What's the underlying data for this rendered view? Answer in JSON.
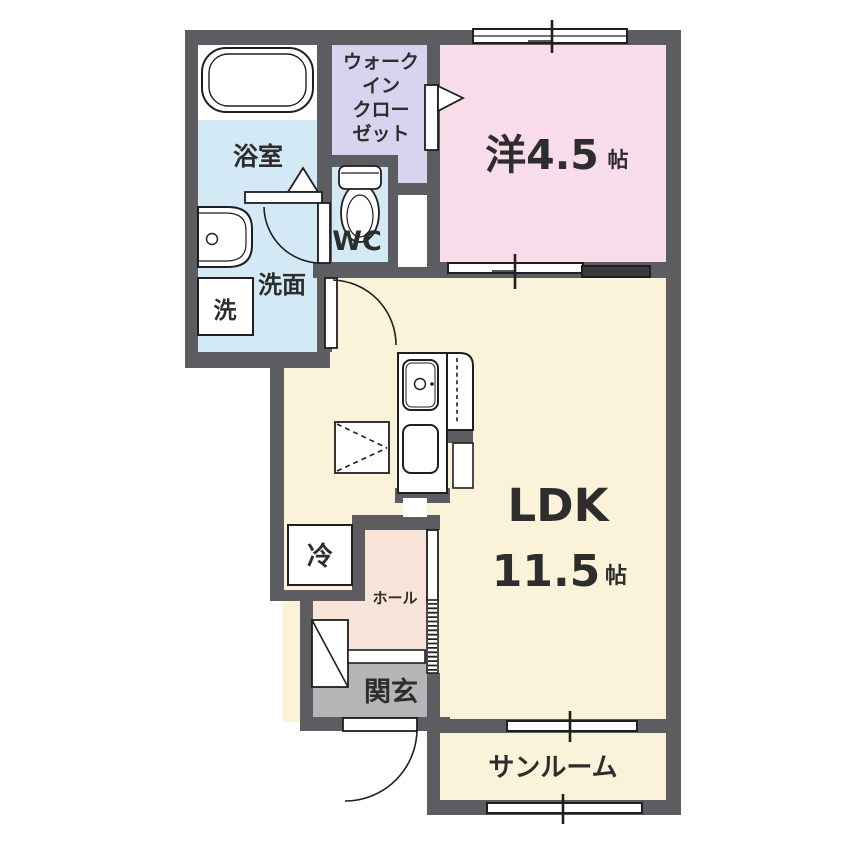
{
  "floorplan": {
    "rooms": {
      "walk_in_closet": {
        "line1": "ウォーク",
        "line2": "イン",
        "line3": "クロー",
        "line4": "ゼット"
      },
      "bathroom": {
        "label": "浴室"
      },
      "washroom": {
        "label": "洗面"
      },
      "washing_machine": {
        "label": "洗"
      },
      "toilet": {
        "label": "WC"
      },
      "western_room": {
        "size_label": "洋4.5",
        "unit": "帖"
      },
      "ldk": {
        "name": "LDK",
        "size": "11.5",
        "unit": "帖"
      },
      "refrigerator": {
        "label": "冷"
      },
      "hall": {
        "label": "ホール"
      },
      "entrance": {
        "label": "関玄"
      },
      "sunroom": {
        "label": "サンルーム"
      }
    },
    "colors": {
      "wall": "#5d5c60",
      "western_room_fill": "#f8dcea",
      "closet_fill": "#d6d4ee",
      "wet_area_fill": "#d3e9f5",
      "ldk_fill": "#faf3da",
      "hall_fill": "#f9e4da",
      "entrance_fill": "#b5b4b6",
      "fixture_fill": "#ffffff",
      "line": "#222222"
    }
  }
}
